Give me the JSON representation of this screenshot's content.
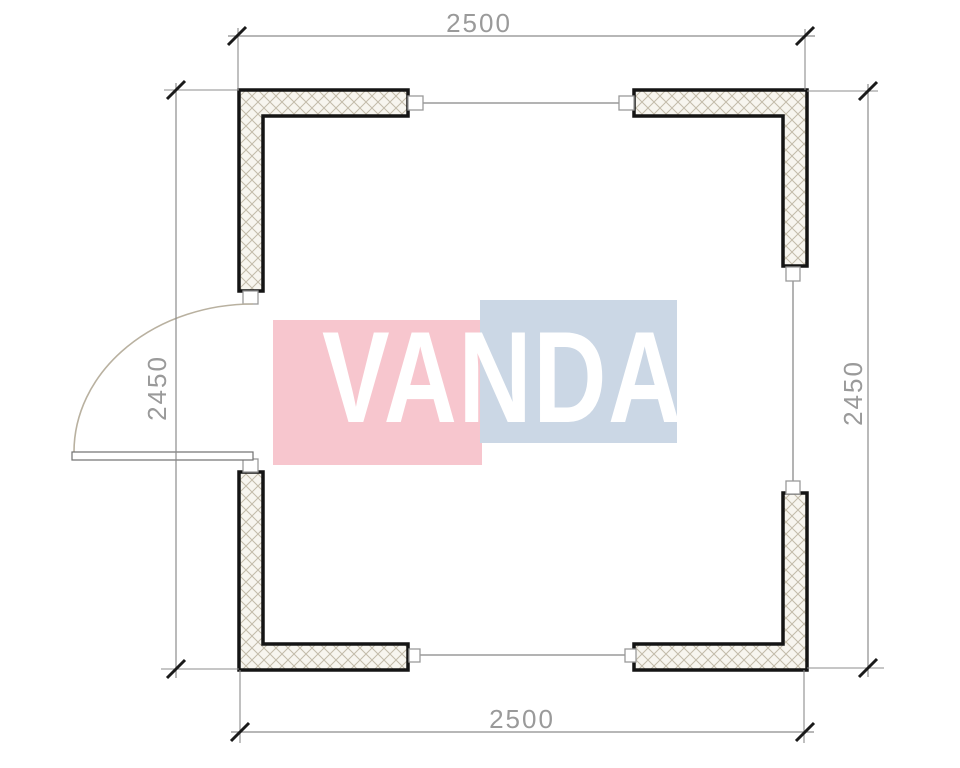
{
  "watermark": {
    "text": "VANDA",
    "pink_color": "#f7c6ce",
    "blue_color": "#cbd7e5",
    "text_color": "#ffffff"
  },
  "dimensions": {
    "top": "2500",
    "bottom": "2500",
    "left": "2450",
    "right": "2450"
  },
  "colors": {
    "background": "#ffffff",
    "wall_outline": "#141414",
    "wall_fill": "#f7f5ef",
    "wall_hatch": "#c2bba9",
    "dimension_line": "#8c8c8c",
    "dimension_text": "#9a9a9a",
    "tick": "#1a1a1a",
    "window_line": "#9a9a9a",
    "marker_border": "#9a9a9a",
    "door_arc": "#b9b1a0",
    "door_leaf_border": "#707070"
  }
}
